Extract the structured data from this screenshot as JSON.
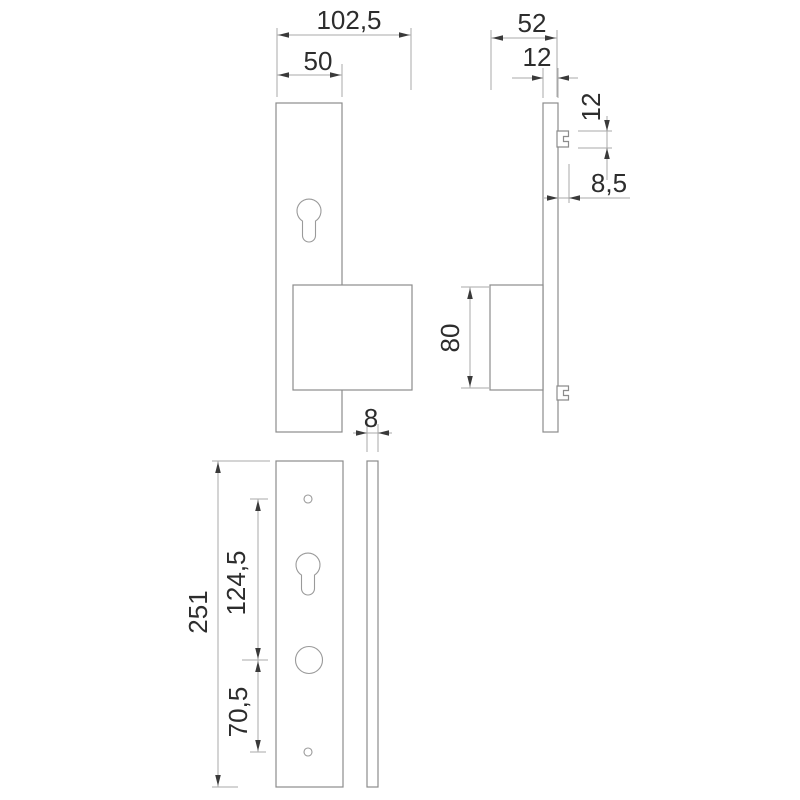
{
  "drawing": {
    "type": "technical-dimension-drawing",
    "subject": "door-plate-with-handle-front-and-side-views",
    "dimensions": {
      "front_overall_width": "102,5",
      "front_plate_width": "50",
      "side_overall_depth": "52",
      "side_plate_thickness": "12",
      "side_clip_height": "12",
      "side_clip_offset": "8,5",
      "handle_block_height": "80",
      "lower_plate_thickness": "8",
      "plate_length": "251",
      "upper_hole_spacing": "124,5",
      "lower_hole_spacing": "70,5"
    },
    "colors": {
      "background": "#ffffff",
      "outline": "#8c8c8c",
      "dimension_line": "#a8a8a8",
      "arrow": "#3a3a3a",
      "text": "#2d2d2d"
    }
  }
}
